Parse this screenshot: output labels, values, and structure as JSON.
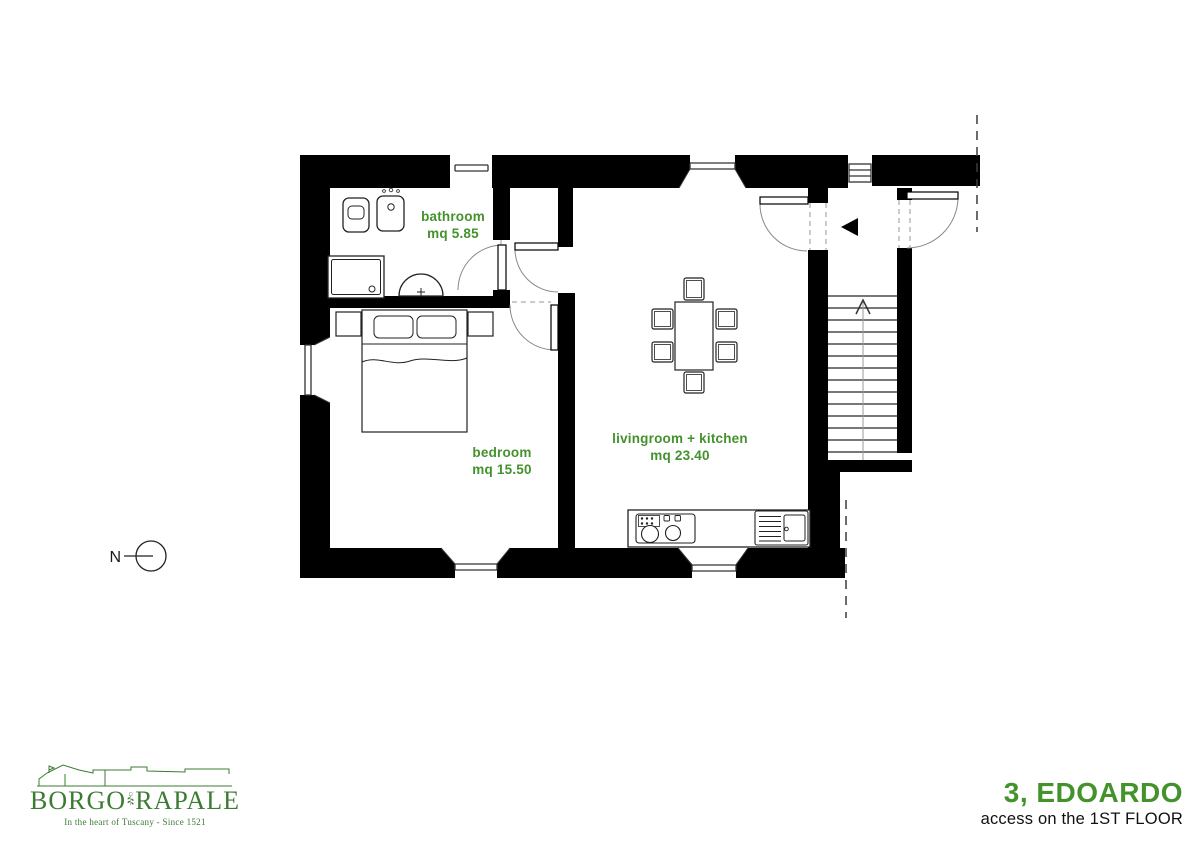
{
  "colors": {
    "label_green": "#44922c",
    "logo_green": "#3c7b33",
    "wall_black": "#000000"
  },
  "plan": {
    "north_label": "N",
    "rooms": [
      {
        "label": "bathroom",
        "area": "mq 5.85"
      },
      {
        "label": "bedroom",
        "area": "mq 15.50"
      },
      {
        "label": "livingroom + kitchen",
        "area": "mq 23.40"
      }
    ]
  },
  "title_block": {
    "apartment": "3, EDOARDO",
    "access": "access on the 1ST FLOOR"
  },
  "logo": {
    "name_left": "BORGO",
    "name_right": "RAPALE",
    "tagline": "In the heart of Tuscany - Since 1521"
  }
}
